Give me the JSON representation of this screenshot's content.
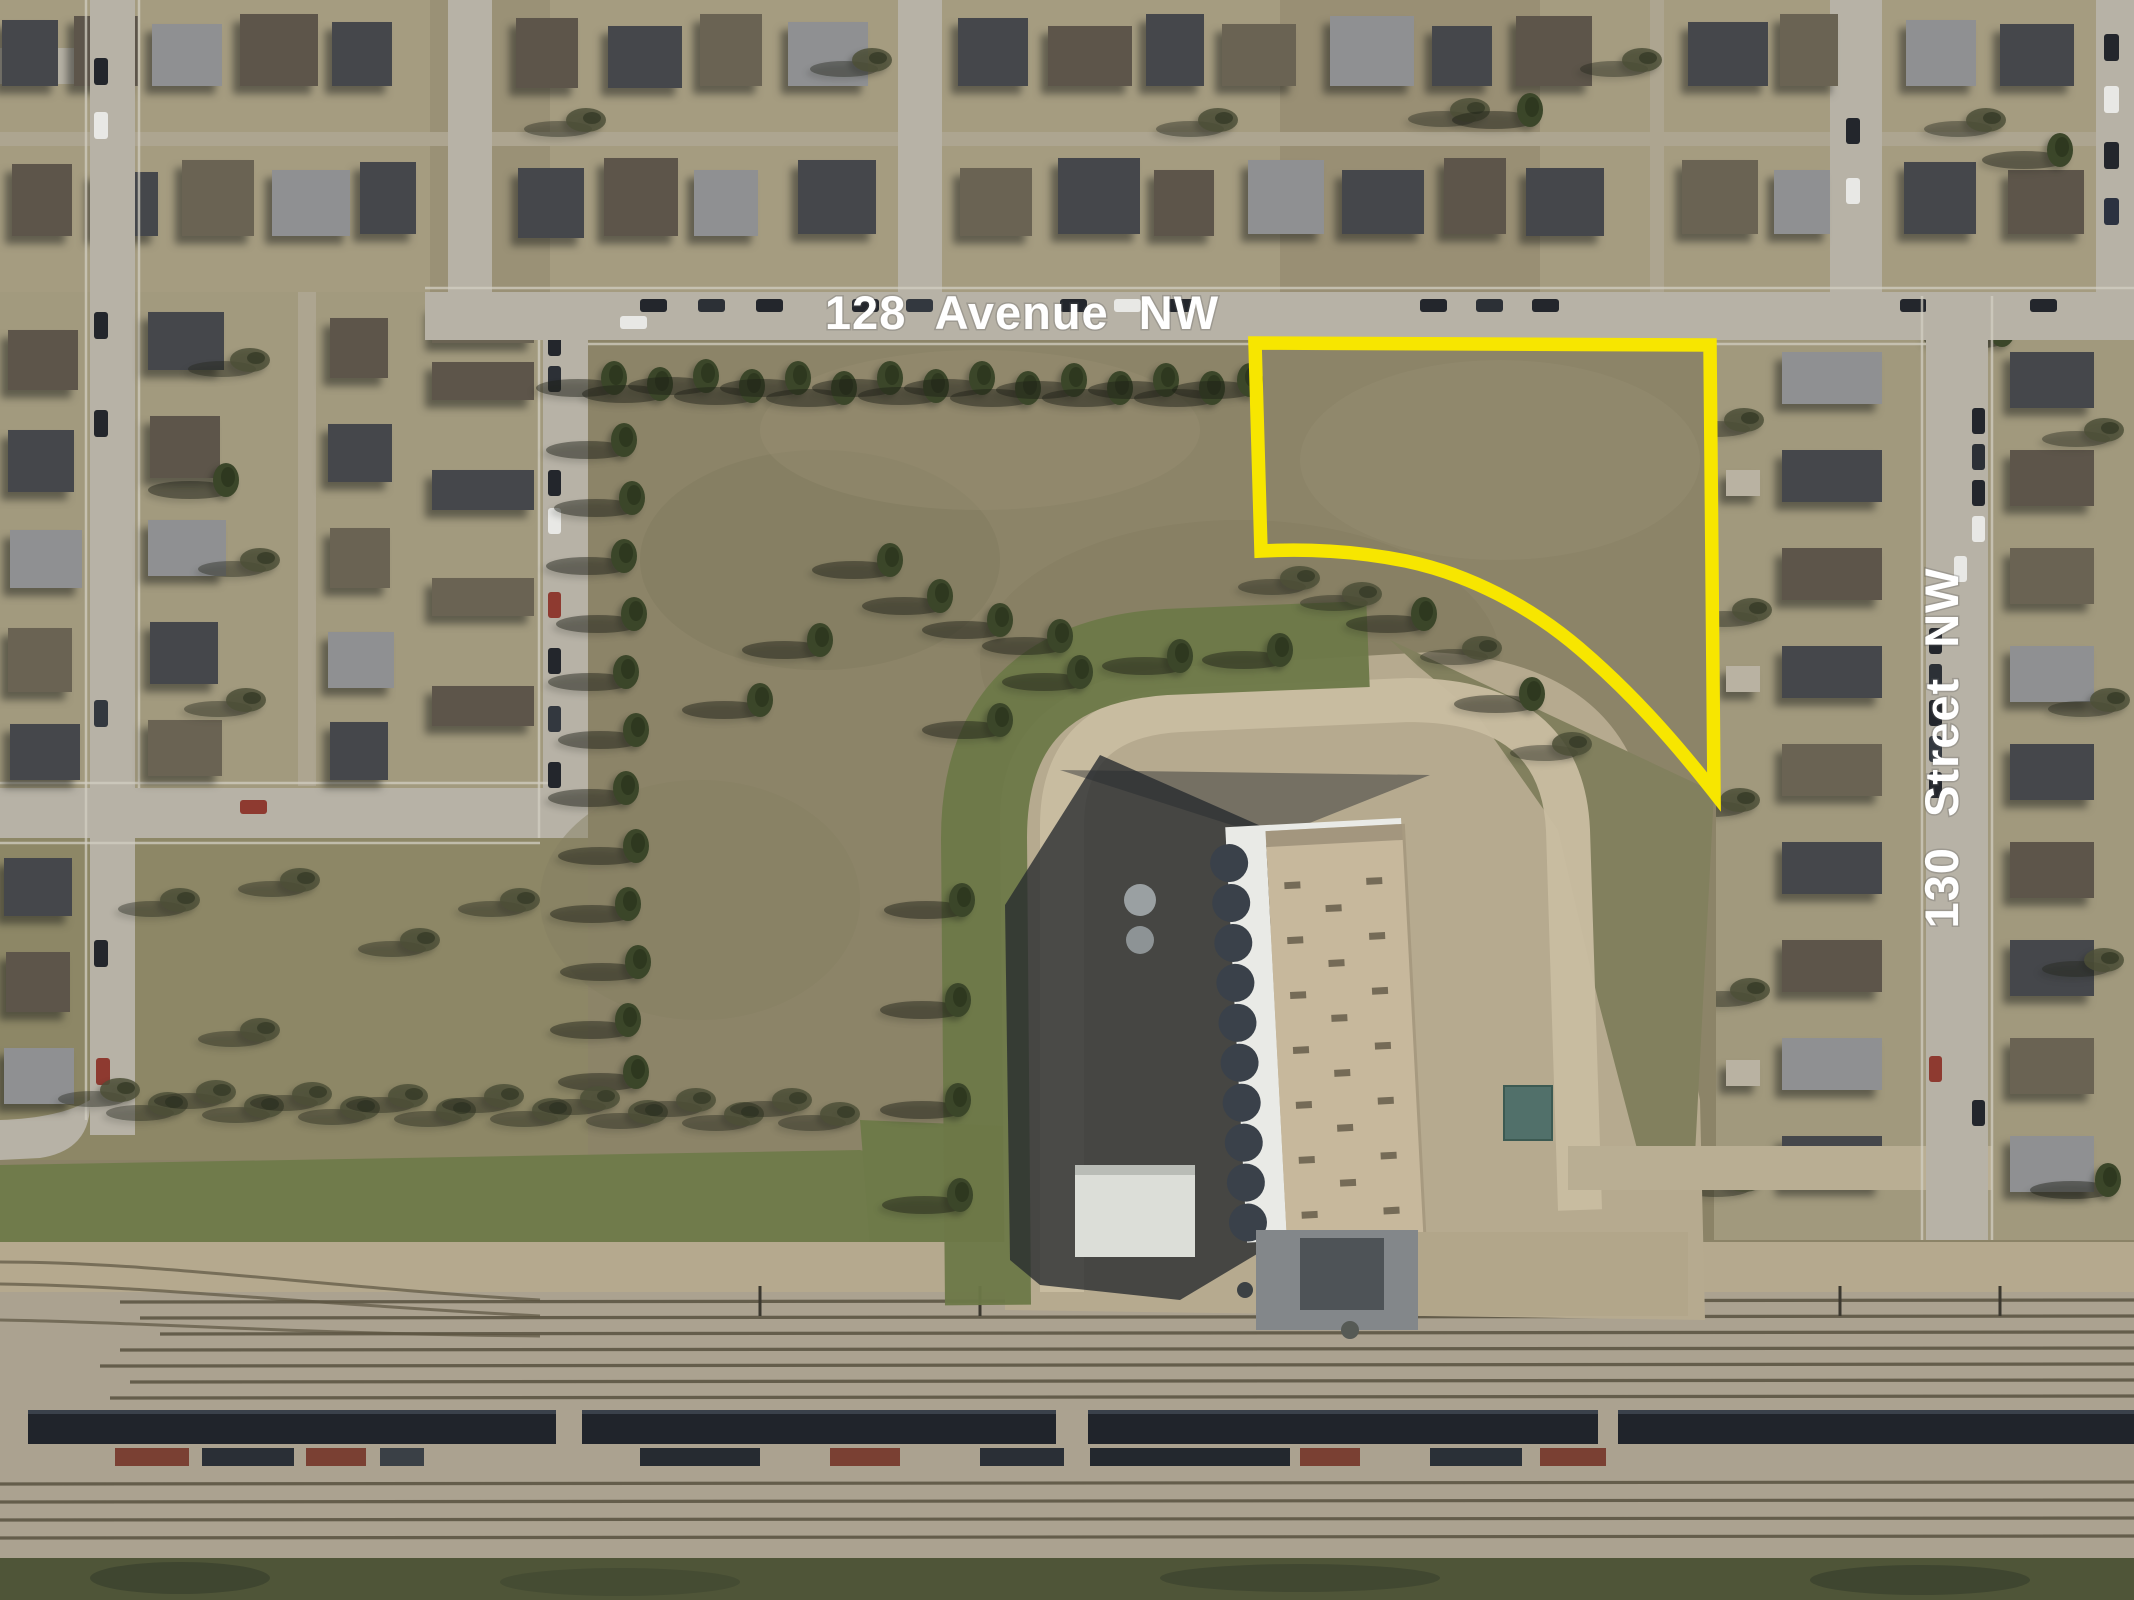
{
  "labels": {
    "avenue": "128 Avenue NW",
    "street": "130 Street NW"
  },
  "annotation": {
    "parcel_outline_color": "#f7e600",
    "parcel_outline_path": "M1255,343 L1710,345 L1714,792 C1670,736 1628,690 1580,649 C1530,606 1468,574 1406,561 C1350,550 1298,549 1261,551 Z"
  },
  "palette": {
    "label_white": "#ffffff",
    "parcel_yellow": "#f7e600",
    "field_olive": "#8b8367",
    "road_gray": "#b7b2a6",
    "neighborhood_tan": "#a59c80",
    "grass_green": "#6f7a4c",
    "berm_green": "#6d7848",
    "dirt_tan": "#b6aa8f",
    "rail_ballast": "#aba290",
    "train_dark": "#20242b",
    "building_roof_tan": "#c7b89c",
    "building_white": "#e9eae6"
  }
}
